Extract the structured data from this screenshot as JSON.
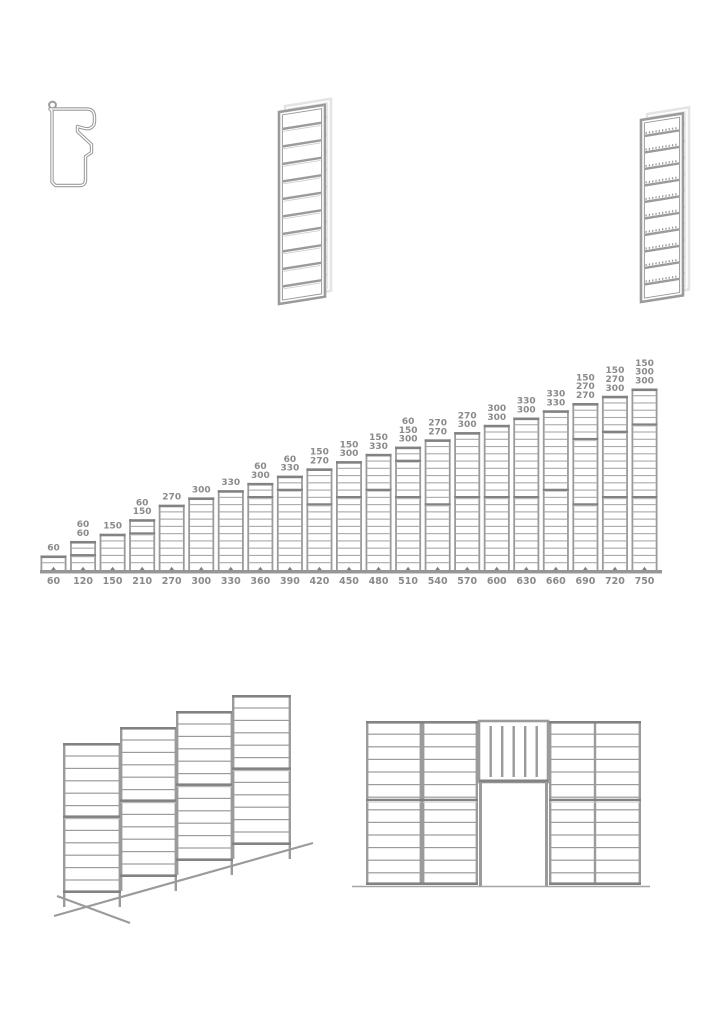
{
  "colors": {
    "line": "#9b9b9b",
    "line_dark": "#828282",
    "line_light": "#cfcfcf",
    "axis": "#969696",
    "label": "#8a8a8a",
    "background": "#ffffff"
  },
  "drawings": {
    "profile": "profile-cross-section",
    "panel_3d_left": "ladder-panel-3d",
    "panel_3d_right": "ladder-panel-3d-serrated",
    "slope": "slope-installation-diagram",
    "gate": "gate-wall-diagram"
  },
  "chart_data": {
    "type": "bar",
    "title": "",
    "xlabel": "",
    "ylabel": "",
    "unit_step": 30,
    "ylim": [
      0,
      750
    ],
    "categories": [
      60,
      120,
      150,
      210,
      270,
      300,
      330,
      360,
      390,
      420,
      450,
      480,
      510,
      540,
      570,
      600,
      630,
      660,
      690,
      720,
      750
    ],
    "stacks": [
      [
        60
      ],
      [
        60,
        60
      ],
      [
        150
      ],
      [
        60,
        150
      ],
      [
        270
      ],
      [
        300
      ],
      [
        330
      ],
      [
        60,
        300
      ],
      [
        60,
        330
      ],
      [
        150,
        270
      ],
      [
        150,
        300
      ],
      [
        150,
        330
      ],
      [
        60,
        150,
        300
      ],
      [
        270,
        270
      ],
      [
        270,
        300
      ],
      [
        300,
        300
      ],
      [
        330,
        300
      ],
      [
        330,
        330
      ],
      [
        150,
        270,
        270
      ],
      [
        150,
        270,
        300
      ],
      [
        150,
        300,
        300
      ]
    ],
    "axis_labels": [
      "60",
      "120",
      "150",
      "210",
      "270",
      "300",
      "330",
      "360",
      "390",
      "420",
      "450",
      "480",
      "510",
      "540",
      "570",
      "600",
      "630",
      "660",
      "690",
      "720",
      "750"
    ],
    "legend": [],
    "grid": false
  }
}
